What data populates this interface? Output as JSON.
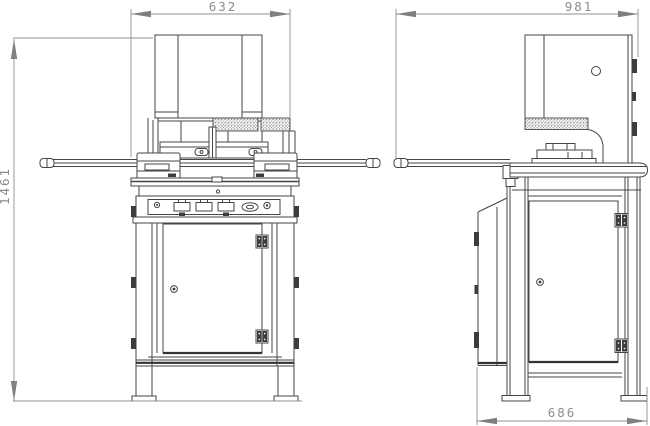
{
  "drawing": {
    "dimensions": {
      "front_width": "632",
      "front_height": "1461",
      "side_width": "981",
      "side_base_width": "686"
    },
    "colors": {
      "line": "#454545",
      "dark_fill": "#3c3c3c",
      "dimension_line": "#8f8f8f",
      "dimension_text": "#8c8c8c",
      "background": "#ffffff"
    }
  }
}
